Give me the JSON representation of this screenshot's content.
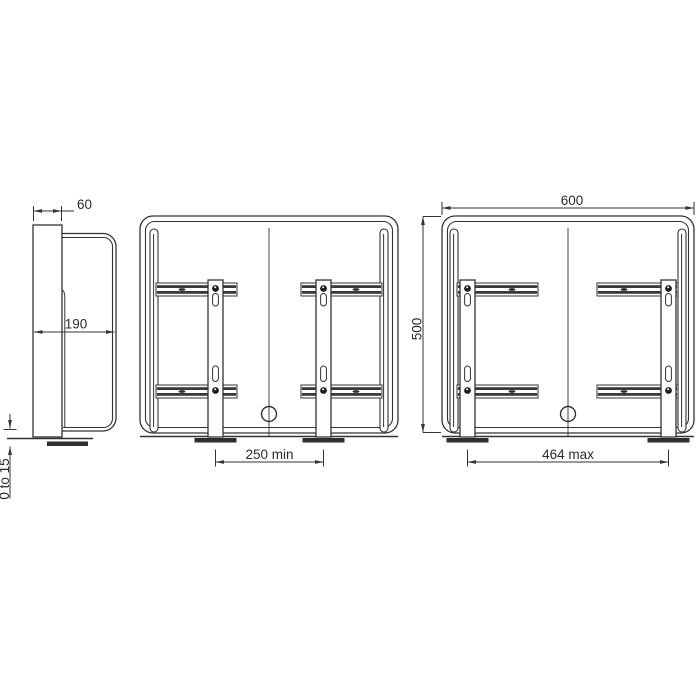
{
  "page": {
    "background_color": "#ffffff",
    "line_color": "#333333",
    "text_color": "#2b2b2b"
  },
  "drawing": {
    "type": "technical_drawing",
    "description_visible_text_only": true,
    "views": {
      "side_view": {
        "dim_depth_top": "60",
        "dim_depth_overall": "190",
        "dim_floor_clearance": "0 to 15"
      },
      "front_view_min": {
        "dim_bracket_spacing": "250 min"
      },
      "front_view_max": {
        "dim_overall_width": "600",
        "dim_overall_height": "500",
        "dim_bracket_spacing": "464 max"
      }
    }
  }
}
